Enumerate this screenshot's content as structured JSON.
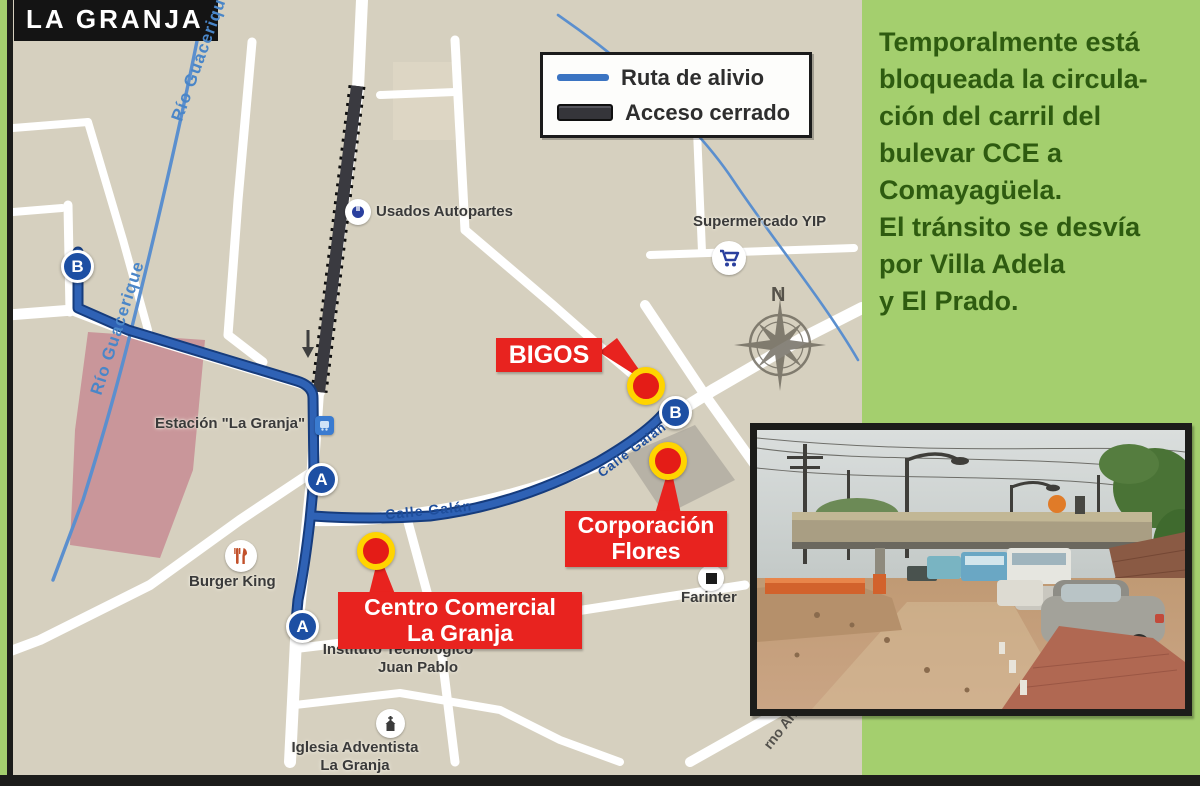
{
  "title": "LA GRANJA",
  "legend": {
    "ruta_label": "Ruta de alivio",
    "acceso_label": "Acceso cerrado"
  },
  "sidebar": {
    "text": "Temporalmente está\nbloqueada la circula-\nción del carril del\nbulevar CCE a\nComayagüela.\nEl tránsito se desvía\npor Villa Adela\ny El Prado."
  },
  "map": {
    "river_label": "Río Guacerique",
    "street_galan": "Calle Galán",
    "street_arbo": "rno Arbo",
    "compass_n": "N",
    "markers": {
      "a": "A",
      "b": "B"
    },
    "poi": {
      "usados": "Usados Autopartes",
      "supermercado": "Supermercado YIP",
      "estacion": "Estación \"La Granja\"",
      "burger": "Burger King",
      "farinter": "Farinter",
      "instituto_1": "Instituto Tecnológico",
      "instituto_2": "Juan Pablo",
      "iglesia_1": "Iglesia Adventista",
      "iglesia_2": "La Granja"
    },
    "callouts": {
      "bigos": "BIGOS",
      "corporacion_1": "Corporación",
      "corporacion_2": "Flores",
      "centro_1": "Centro Comercial",
      "centro_2": "La Granja"
    }
  },
  "colors": {
    "panel_green": "#a4cf6e",
    "route_blue": "#2f62b5",
    "closed_black": "#35353a",
    "callout_red": "#e8231f",
    "marker_yellow": "#ffd400",
    "map_beige": "#d6d0bf"
  }
}
